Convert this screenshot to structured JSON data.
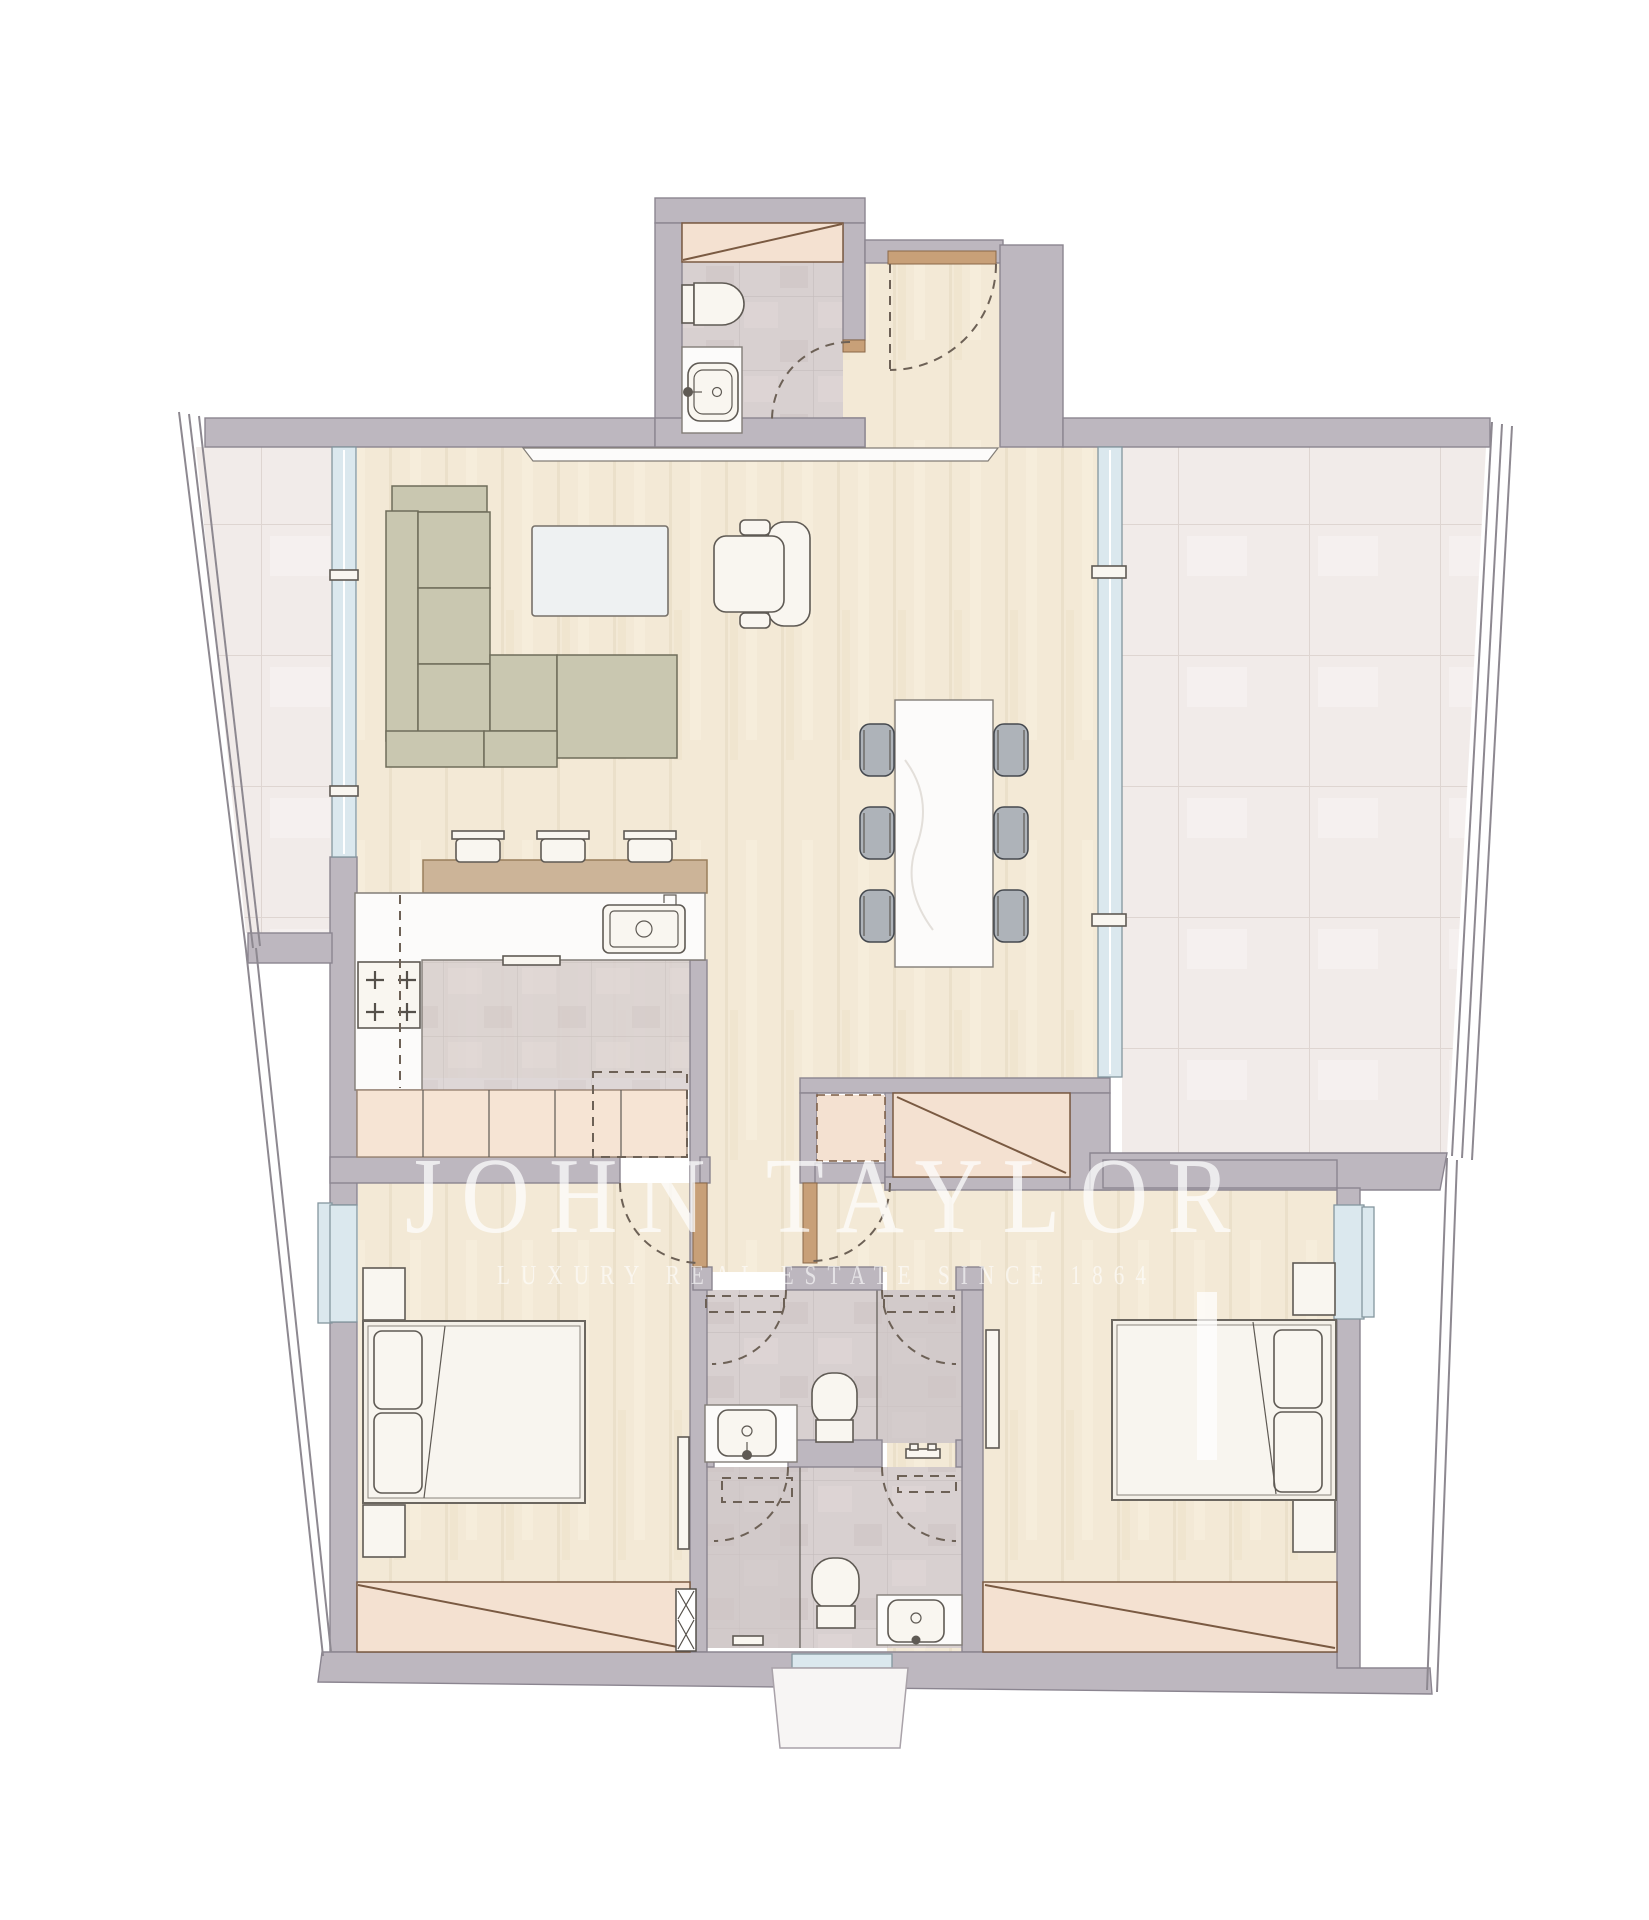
{
  "canvas": {
    "width": 1649,
    "height": 1920
  },
  "watermark": {
    "title": "JOHN TAYLOR",
    "subtitle": "LUXURY REAL ESTATE SINCE 1864"
  },
  "palette": {
    "wall": "#bdb7bf",
    "wall-stroke": "#8b8590",
    "wood": "#f3e9d6",
    "wood-line": "#e4d8bf",
    "tile-terrace": "#f1ebe9",
    "tile-terrace-line": "#ded5d1",
    "tile-bath": "#d8d0d0",
    "tile-bath-line": "#c0b6b6",
    "tile-bath-dark": "#cfc6c6",
    "closet": "#f4e1d1",
    "closet-line": "#7a5a42",
    "cabinet": "#f6e4d4",
    "cabinet-line": "#9a8474",
    "sofa": "#c9c7b0",
    "sofa-line": "#6f6d5a",
    "chair": "#aeb3b9",
    "chair-line": "#45494f",
    "furn-white": "#f9f6f0",
    "furn-line": "#5f5a54",
    "marble": "#fcfbfa",
    "marble-line": "#827d77",
    "bar-wood": "#ccb498",
    "bar-line": "#9a7f5c",
    "glass": "#dbe8ee",
    "glass-frame": "#84969f",
    "threshold": "#c8a078",
    "threshold-line": "#8a6848",
    "arc-dash": "#6d6156",
    "rail": "#8d8890"
  },
  "elements": {
    "rooms": [
      "entry-hall",
      "guest-wc",
      "living-room",
      "dining-area",
      "kitchen",
      "corridor",
      "bedroom-1",
      "bedroom-2",
      "bathroom-1",
      "bathroom-2",
      "terrace-left",
      "terrace-right"
    ],
    "furniture": [
      "sectional-sofa",
      "coffee-table",
      "armchair",
      "tv-console",
      "dining-table",
      "dining-chair",
      "bar-counter",
      "bar-stool",
      "kitchen-island",
      "island-sink",
      "cooktop",
      "kitchen-cabinets",
      "overhead-cabinet",
      "double-bed",
      "pillow",
      "nightstand",
      "wardrobe",
      "toilet",
      "washbasin",
      "shower",
      "window",
      "sliding-glass-door",
      "door-swing",
      "entrance-door"
    ]
  }
}
